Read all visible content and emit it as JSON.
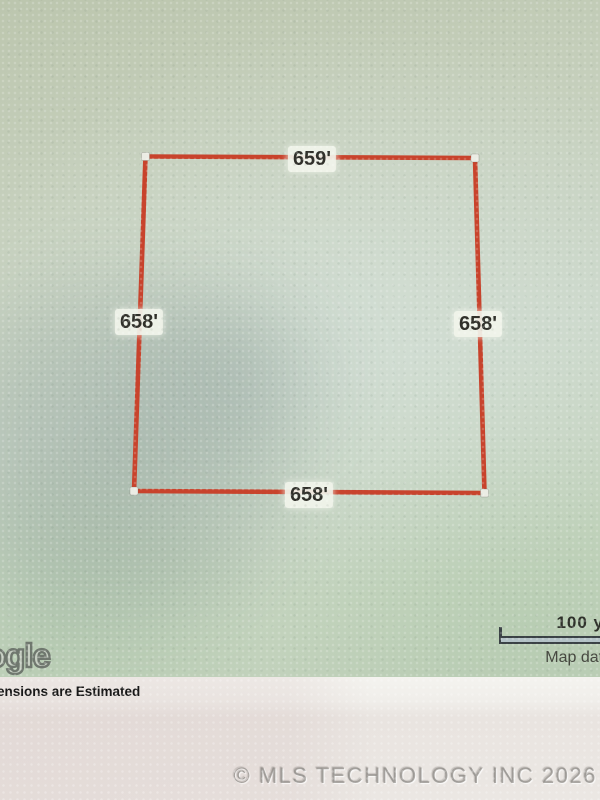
{
  "parcel": {
    "top_dimension": "659'",
    "right_dimension": "658'",
    "bottom_dimension": "658'",
    "left_dimension": "658'"
  },
  "map": {
    "logo_visible_text": "ogle",
    "scale_label": "100 y",
    "attribution": "Map data"
  },
  "footer": {
    "disclaimer": "ensions are Estimated",
    "watermark": "© MLS TECHNOLOGY INC 2026"
  },
  "colors": {
    "parcel_line": "#c8432c",
    "map_background": "#c6d0bd",
    "paper_background": "#ebe7e3"
  }
}
